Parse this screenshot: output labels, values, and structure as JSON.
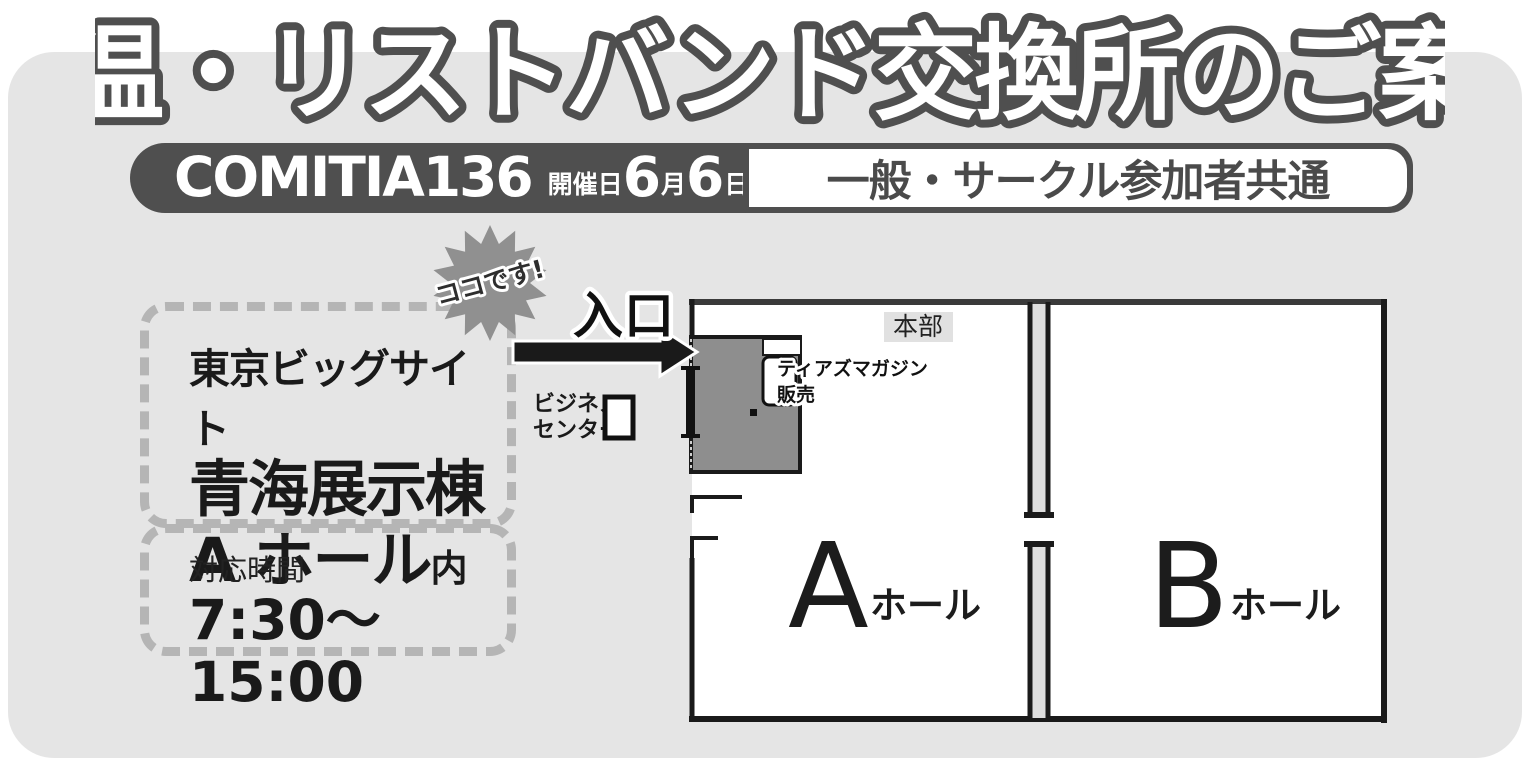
{
  "title": "検温・リストバンド交換所のご案内",
  "event_bar": {
    "event_name": "COMITIA136",
    "date_label": "開催日",
    "month_num": "6",
    "month_unit": "月",
    "day_num": "6",
    "day_unit": "日",
    "audience": "一般・サークル参加者共通"
  },
  "location_box": {
    "line1": "東京ビッグサイト",
    "line2": "青海展示棟",
    "line3_main": "A ホール",
    "line3_suffix": "内"
  },
  "hours_box": {
    "label": "対応時間",
    "time": "7:30〜15:00"
  },
  "callout": {
    "burst": "ココです!",
    "entrance": "入口"
  },
  "map": {
    "hq_label": "本部",
    "tears_line1": "ティアズマガジン",
    "tears_line2": "販売",
    "business_line1": "ビジネス",
    "business_line2": "センター",
    "hall_a_letter": "A",
    "hall_a_suffix": "ホール",
    "hall_b_letter": "B",
    "hall_b_suffix": "ホール"
  },
  "colors": {
    "panel_bg": "#e5e5e5",
    "accent_dark_gray": "#4f4f4f",
    "burst_gray": "#909090",
    "exchange_area_gray": "#8e8e8e",
    "dashed_border": "#b5b5b5",
    "wall_black": "#1a1a1a"
  }
}
